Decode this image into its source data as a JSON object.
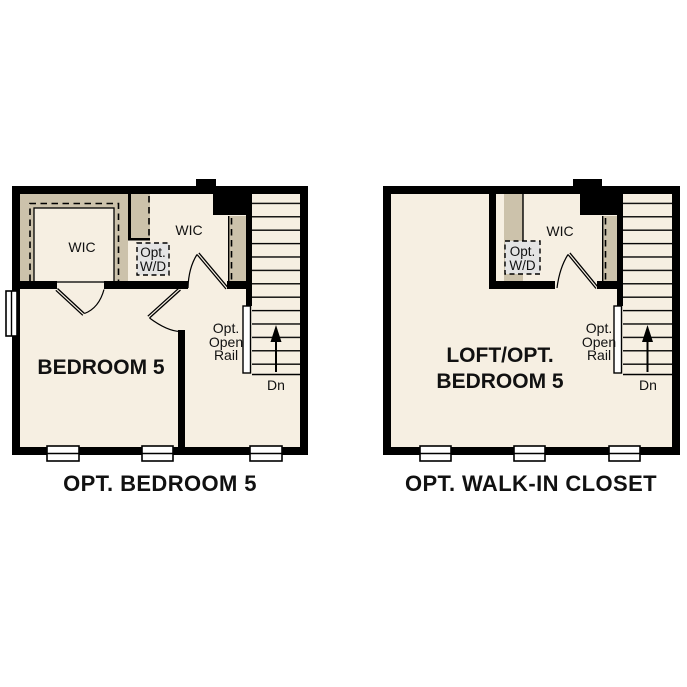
{
  "colors": {
    "page_bg": "#ffffff",
    "wall": "#000000",
    "floor": "#f6efe2",
    "closet_shelf": "#ccc2ab",
    "wd_box_fill": "#e4e4e4",
    "window": "#ffffff",
    "text": "#111111"
  },
  "plans": {
    "left": {
      "caption": "OPT. BEDROOM 5",
      "room_label": "BEDROOM 5",
      "wic_left_label": "WIC",
      "wic_mid_label": "WIC",
      "opt_wd": {
        "line1": "Opt.",
        "line2": "W/D"
      },
      "open_rail": {
        "line1": "Opt.",
        "line2": "Open",
        "line3": "Rail"
      },
      "stairs_label": "Dn"
    },
    "right": {
      "caption": "OPT. WALK-IN CLOSET",
      "room_label_line1": "LOFT/OPT.",
      "room_label_line2": "BEDROOM 5",
      "wic_label": "WIC",
      "opt_wd": {
        "line1": "Opt.",
        "line2": "W/D"
      },
      "open_rail": {
        "line1": "Opt.",
        "line2": "Open",
        "line3": "Rail"
      },
      "stairs_label": "Dn"
    }
  }
}
